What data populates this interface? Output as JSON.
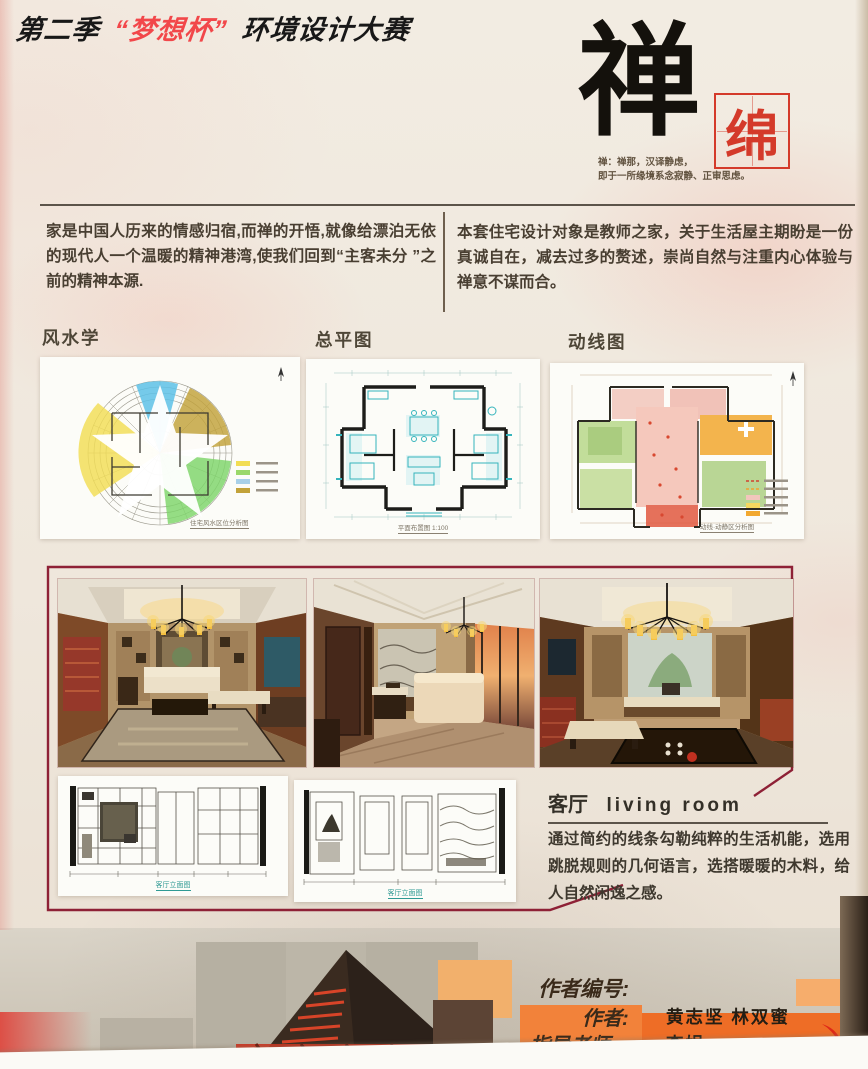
{
  "header": {
    "title_prefix": "第二季",
    "title_highlight": "“梦想杯”",
    "title_suffix": "环境设计大赛"
  },
  "calligraphy": {
    "main_char": "禅",
    "seal_char": "绵",
    "definition_line1": "禅：禅那，汉译静虑，",
    "definition_line2": "即于一所缘境系念寂静、正审思虑。"
  },
  "intro": {
    "left": "家是中国人历来的情感归宿,而禅的开悟,就像给漂泊无依的现代人一个温暖的精神港湾,使我们回到“主客未分 ”之前的精神本源.",
    "right": "本套住宅设计对象是教师之家，关于生活屋主期盼是一份真诚自在，减去过多的赘述，崇尚自然与注重内心体验与禅意不谋而合。"
  },
  "sections": {
    "fengshui": "风水学",
    "siteplan": "总平图",
    "circulation": "动线图"
  },
  "captions": {
    "fengshui": "住宅风水区位分析图",
    "siteplan": "平面布置图  1:100",
    "circulation": "动线·动静区分析图",
    "elevation_left": "客厅立面图",
    "elevation_right": "客厅立面图"
  },
  "living_room": {
    "heading_cn": "客厅",
    "heading_en": "living room",
    "body": "通过简约的线条勾勒纯粹的生活机能，选用跳脱规则的几何语言，选搭暖暖的木料，给人自然闲逸之感。"
  },
  "credits": {
    "id_label": "作者编号:",
    "author_label": "作者:",
    "authors": "黄志坚  林双蜜",
    "advisor_label": "指导老师:",
    "advisor": "李娟"
  },
  "colors": {
    "title_red": "#f2474a",
    "seal_red": "#d43a2a",
    "frame_maroon": "#8e2136",
    "caption_teal": "#2f9a94",
    "credit_orange": "#ee6d26"
  }
}
